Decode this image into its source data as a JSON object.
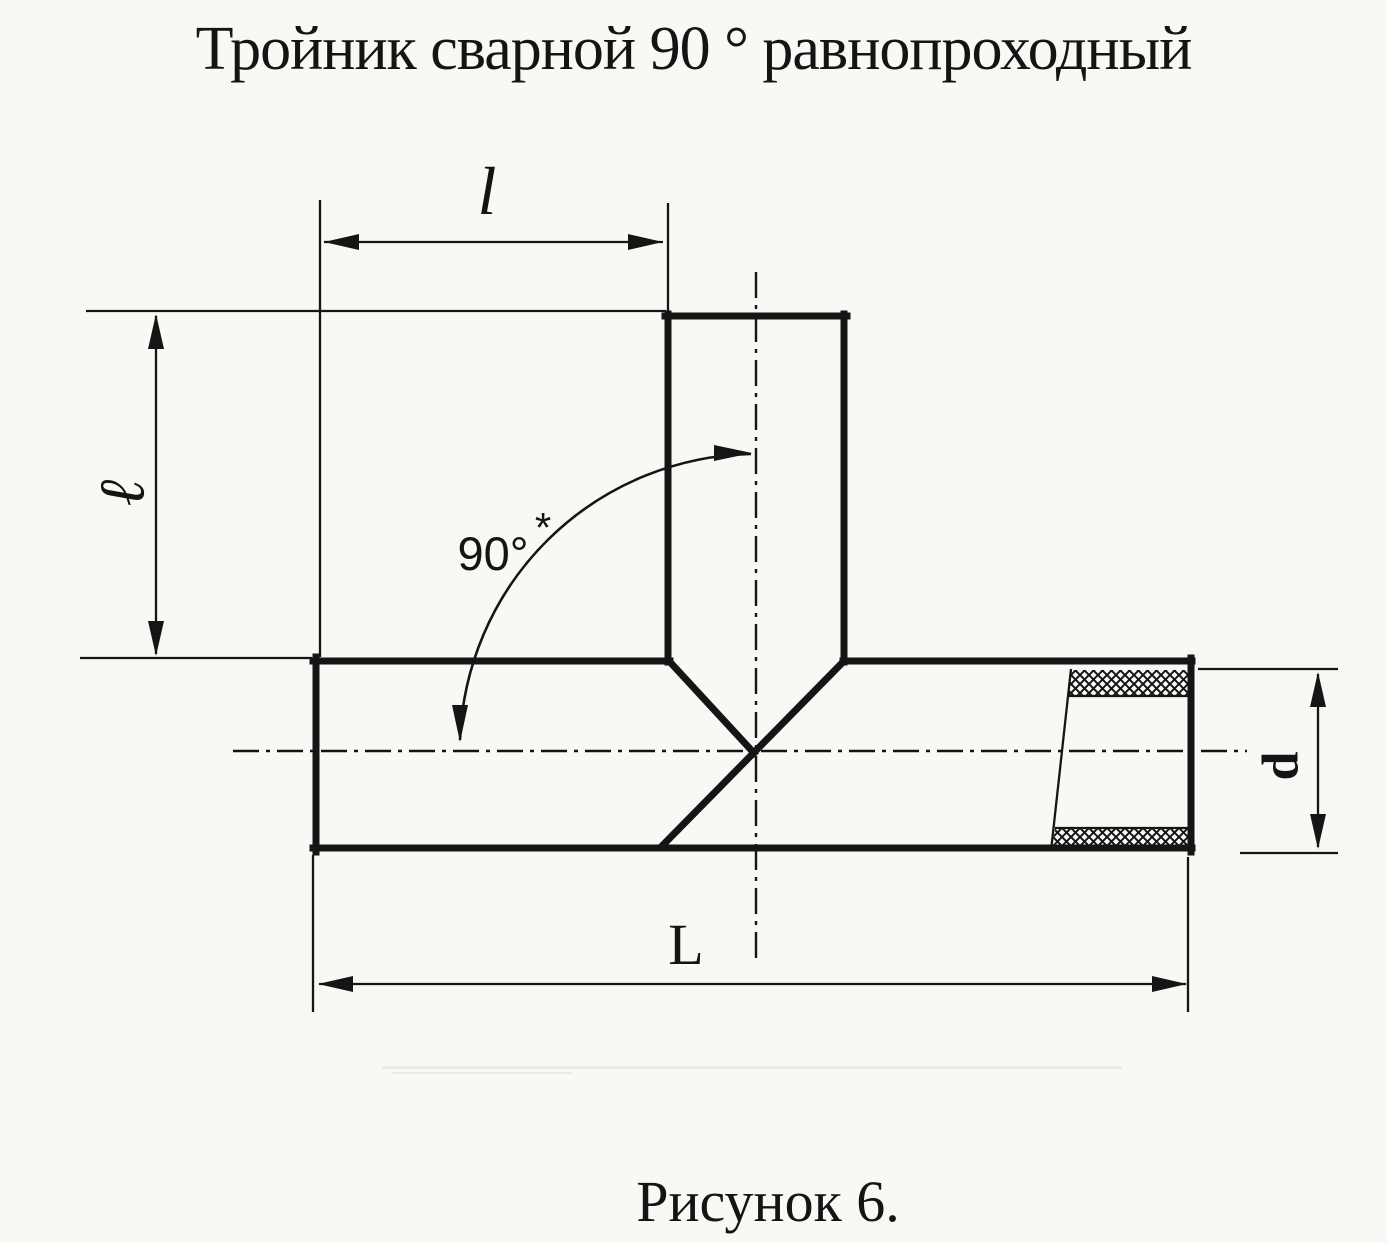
{
  "title": "Тройник сварной 90 ° равнопроходный",
  "caption": "Рисунок 6.",
  "labels": {
    "top_length": "l",
    "side_height": "ℓ",
    "overall_length": "L",
    "diameter": "d",
    "angle": "90°",
    "angle_note": "*"
  },
  "colors": {
    "paper": "#f8f8f5",
    "ink": "#151515"
  }
}
